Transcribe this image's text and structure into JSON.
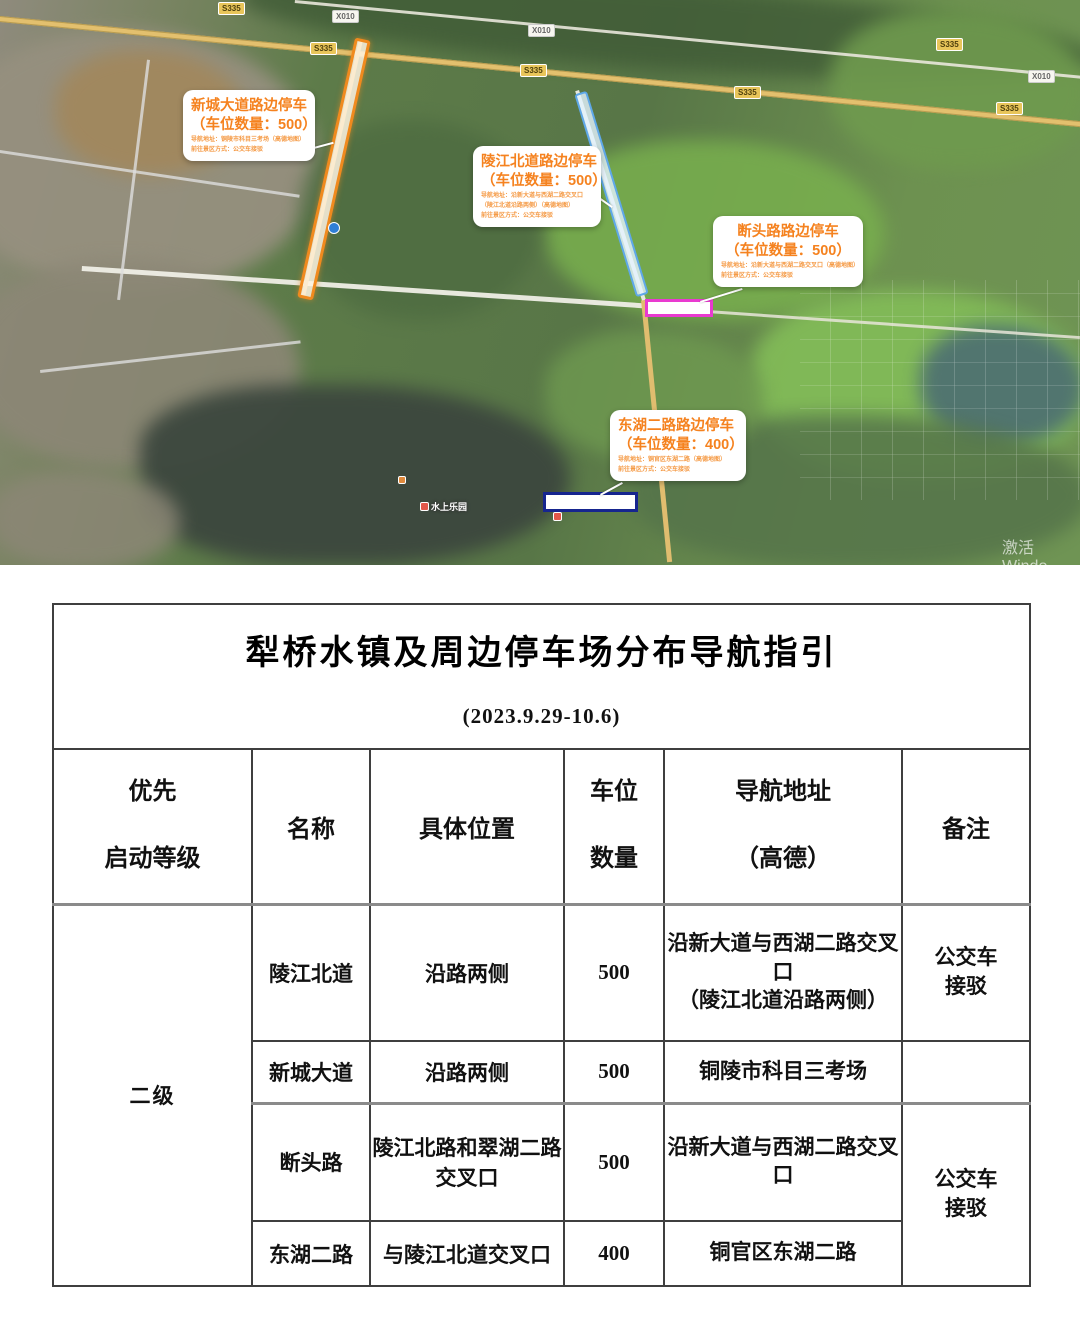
{
  "map": {
    "badges": {
      "s335": "S335",
      "x010": "X010"
    },
    "poi": {
      "water_park": "水上乐园"
    },
    "watermark": {
      "line1": "激活 Windo",
      "line2": "转到“设置”以激活 Win"
    },
    "colors": {
      "callout_text": "#F5821F",
      "strip_xincheng": "#F08A1E",
      "strip_lingjiang": "#5FA8E8",
      "rect_duantou": "#E93AD0",
      "rect_donghu": "#16258F"
    },
    "callouts": [
      {
        "title": "新城大道路边停车",
        "count_line": "（车位数量：500）",
        "lines": [
          "导航地址：铜陵市科目三考场（高德地图）",
          "前往景区方式：公交车接驳"
        ]
      },
      {
        "title": "陵江北道路边停车",
        "count_line": "（车位数量：500）",
        "lines": [
          "导航地址：沿新大道与西湖二路交叉口",
          "（陵江北道沿路两侧）（高德地图）",
          "前往景区方式：公交车接驳"
        ]
      },
      {
        "title": "断头路路边停车",
        "count_line": "（车位数量：500）",
        "lines": [
          "导航地址：沿新大道与西湖二路交叉口（高德地图）",
          "前往景区方式：公交车接驳"
        ]
      },
      {
        "title": "东湖二路路边停车",
        "count_line": "（车位数量：400）",
        "lines": [
          "导航地址：铜官区东湖二路（高德地图）",
          "前往景区方式：公交车接驳"
        ]
      }
    ]
  },
  "table": {
    "title": "犁桥水镇及周边停车场分布导航指引",
    "subtitle": "(2023.9.29-10.6)",
    "headers": {
      "priority": [
        "优先",
        "启动等级"
      ],
      "name": "名称",
      "location": "具体位置",
      "count": [
        "车位",
        "数量"
      ],
      "nav": [
        "导航地址",
        "（高德）"
      ],
      "remark": "备注"
    },
    "priority": "二级",
    "rows": [
      {
        "name": "陵江北道",
        "location": "沿路两侧",
        "count": "500",
        "nav": [
          "沿新大道与西湖二路交叉口",
          "（陵江北道沿路两侧）"
        ],
        "remark": [
          "公交车",
          "接驳"
        ]
      },
      {
        "name": "新城大道",
        "location": "沿路两侧",
        "count": "500",
        "nav": [
          "铜陵市科目三考场"
        ],
        "remark": []
      },
      {
        "name": "断头路",
        "location": "陵江北路和翠湖二路交叉口",
        "count": "500",
        "nav": [
          "沿新大道与西湖二路交叉口"
        ],
        "remark": [
          "公交车",
          "接驳"
        ]
      },
      {
        "name": "东湖二路",
        "location": "与陵江北道交叉口",
        "count": "400",
        "nav": [
          "铜官区东湖二路"
        ],
        "remark": []
      }
    ]
  }
}
